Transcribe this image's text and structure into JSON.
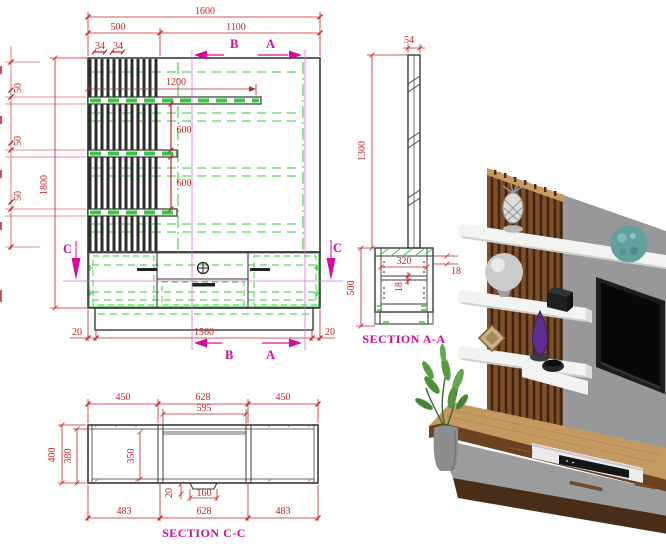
{
  "colors": {
    "dimension": "#c22424",
    "section_mark": "#d60a9e",
    "hidden_line": "#35c93c",
    "outline": "#3a3a3a",
    "wood": "#7d4e28",
    "panel_gray": "#96989a",
    "shelf_white": "#f3f3f1",
    "teal": "#62a09e"
  },
  "front_elevation": {
    "width_total": "1600",
    "width_left": "500",
    "width_right": "1100",
    "slat_gap_1": "34",
    "slat_gap_2": "34",
    "shelf_long": "1200",
    "shelf_gap_1": "600",
    "shelf_gap_2": "600",
    "height_total": "1800",
    "thickness_1": "50",
    "thickness_2": "50",
    "thickness_3": "50",
    "plinth_left": "20",
    "plinth_width": "1560",
    "plinth_right": "20",
    "mark_a": "A",
    "mark_b": "B",
    "mark_c": "C"
  },
  "section_aa": {
    "title": "SECTION A-A",
    "panel_thickness": "54",
    "upper_height": "1300",
    "lower_height": "500",
    "inner_depth": "320",
    "shelf_thickness": "18",
    "top_thickness": "18"
  },
  "section_cc": {
    "title": "SECTION C-C",
    "top_left": "450",
    "top_mid": "628",
    "top_right": "450",
    "opening": "595",
    "height": "400",
    "inner_height": "380",
    "door_height": "350",
    "handle_drop": "20",
    "handle_width": "160",
    "bottom_left": "483",
    "bottom_mid": "628",
    "bottom_right": "483"
  }
}
